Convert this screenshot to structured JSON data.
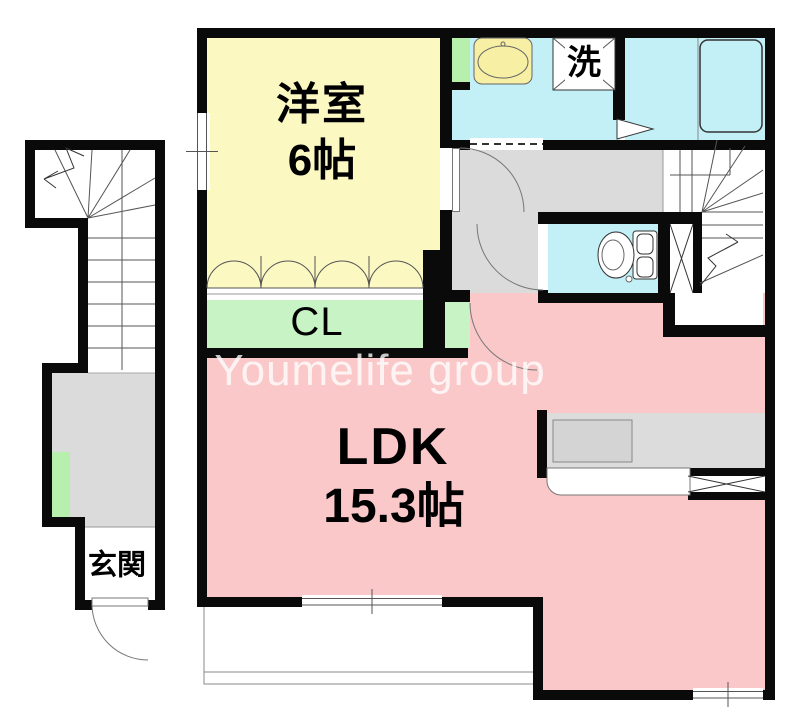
{
  "plan": {
    "watermark": "Youmelife group",
    "labels": {
      "western_room": "洋室",
      "western_room_size": "6帖",
      "closet": "CL",
      "ldk": "LDK",
      "ldk_size": "15.3帖",
      "laundry": "洗",
      "entrance": "玄関"
    },
    "colors": {
      "room_yellow": "#FBF8C2",
      "water_cyan": "#C3F0F7",
      "ldk_pink": "#FAC8C9",
      "closet_green": "#C7F3C5",
      "accent_green": "#B7EFAC",
      "hall_gray": "#DBDBDB",
      "counter_gray": "#DCDCDC",
      "fixture_yellow": "#F6EFA4",
      "wall_black": "#0A0A0A"
    }
  }
}
